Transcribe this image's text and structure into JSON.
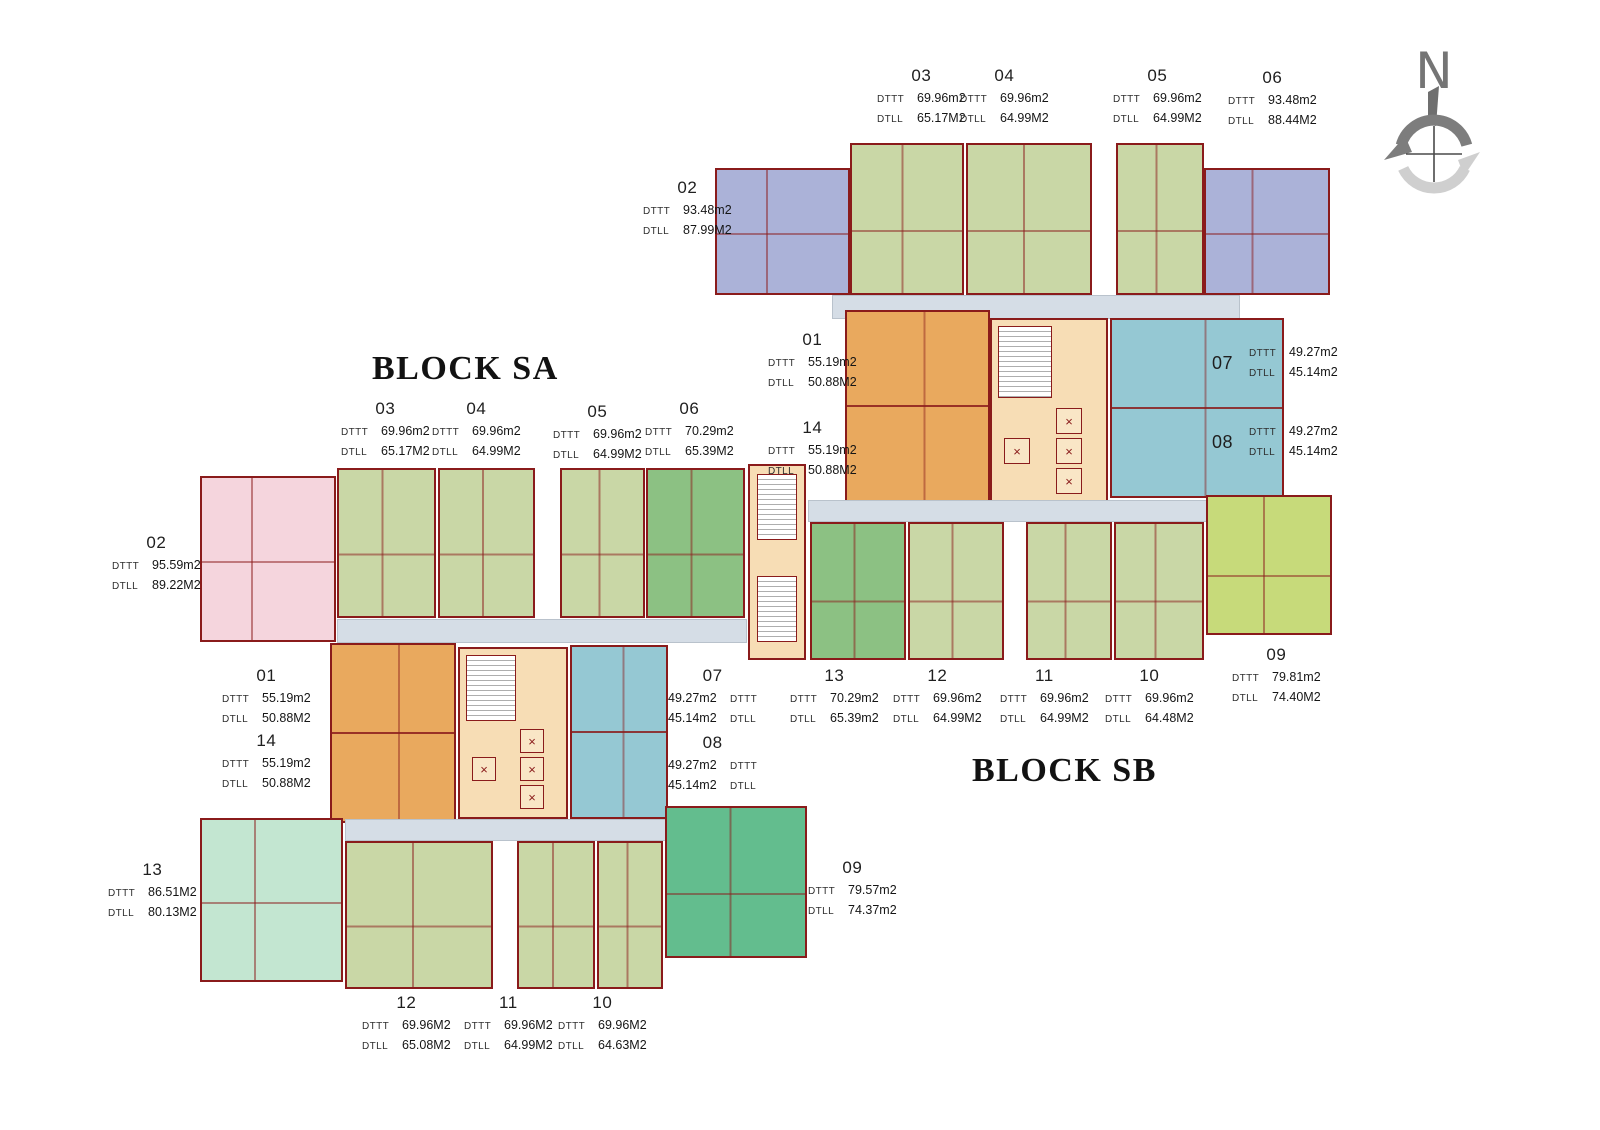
{
  "titles": {
    "block_sa": "BLOCK SA",
    "block_sb": "BLOCK SB"
  },
  "compass": {
    "letter": "N"
  },
  "colors": {
    "wall": "#8a1b1b",
    "unit_green": "#c9d7a6",
    "unit_green_dark": "#8cc183",
    "unit_periwinkle": "#abb2d8",
    "unit_orange": "#e9a95e",
    "unit_teal": "#95c8d3",
    "unit_pink": "#f5d5dd",
    "unit_mint": "#c3e6d1",
    "unit_teal_green": "#63bd8e",
    "unit_lime": "#c7da7a",
    "core_cream": "#f7ddb5",
    "corridor": "#d5dde6"
  },
  "block_sa": {
    "labels": [
      {
        "id": "sa-03",
        "unit": "03",
        "layout": "stack",
        "value_first": false,
        "x": 341,
        "y": 399,
        "rows": [
          [
            "DTTT",
            "69.96m2"
          ],
          [
            "DTLL",
            "65.17M2"
          ]
        ]
      },
      {
        "id": "sa-04",
        "unit": "04",
        "layout": "stack",
        "value_first": false,
        "x": 432,
        "y": 399,
        "rows": [
          [
            "DTTT",
            "69.96m2"
          ],
          [
            "DTLL",
            "64.99M2"
          ]
        ]
      },
      {
        "id": "sa-05",
        "unit": "05",
        "layout": "stack",
        "value_first": false,
        "x": 553,
        "y": 402,
        "rows": [
          [
            "DTTT",
            "69.96m2"
          ],
          [
            "DTLL",
            "64.99M2"
          ]
        ]
      },
      {
        "id": "sa-06",
        "unit": "06",
        "layout": "stack",
        "value_first": false,
        "x": 645,
        "y": 399,
        "rows": [
          [
            "DTTT",
            "70.29m2"
          ],
          [
            "DTLL",
            "65.39M2"
          ]
        ]
      },
      {
        "id": "sa-02",
        "unit": "02",
        "layout": "stack",
        "value_first": false,
        "x": 112,
        "y": 533,
        "rows": [
          [
            "DTTT",
            "95.59m2"
          ],
          [
            "DTLL",
            "89.22M2"
          ]
        ]
      },
      {
        "id": "sa-01",
        "unit": "01",
        "layout": "stack",
        "value_first": false,
        "x": 222,
        "y": 666,
        "rows": [
          [
            "DTTT",
            "55.19m2"
          ],
          [
            "DTLL",
            "50.88M2"
          ]
        ]
      },
      {
        "id": "sa-14",
        "unit": "14",
        "layout": "stack",
        "value_first": false,
        "x": 222,
        "y": 731,
        "rows": [
          [
            "DTTT",
            "55.19m2"
          ],
          [
            "DTLL",
            "50.88M2"
          ]
        ]
      },
      {
        "id": "sa-07",
        "unit": "07",
        "layout": "stack",
        "value_first": true,
        "x": 668,
        "y": 666,
        "rows": [
          [
            "DTTT",
            "49.27m2"
          ],
          [
            "DTLL",
            "45.14m2"
          ]
        ]
      },
      {
        "id": "sa-08",
        "unit": "08",
        "layout": "stack",
        "value_first": true,
        "x": 668,
        "y": 733,
        "rows": [
          [
            "DTTT",
            "49.27m2"
          ],
          [
            "DTLL",
            "45.14m2"
          ]
        ]
      },
      {
        "id": "sa-13",
        "unit": "13",
        "layout": "stack",
        "value_first": false,
        "x": 108,
        "y": 860,
        "rows": [
          [
            "DTTT",
            "86.51M2"
          ],
          [
            "DTLL",
            "80.13M2"
          ]
        ]
      },
      {
        "id": "sa-09",
        "unit": "09",
        "layout": "stack",
        "value_first": false,
        "x": 808,
        "y": 858,
        "rows": [
          [
            "DTTT",
            "79.57m2"
          ],
          [
            "DTLL",
            "74.37m2"
          ]
        ]
      },
      {
        "id": "sa-12",
        "unit": "12",
        "layout": "stack",
        "value_first": false,
        "x": 362,
        "y": 993,
        "rows": [
          [
            "DTTT",
            "69.96M2"
          ],
          [
            "DTLL",
            "65.08M2"
          ]
        ]
      },
      {
        "id": "sa-11",
        "unit": "11",
        "layout": "stack",
        "value_first": false,
        "x": 464,
        "y": 993,
        "rows": [
          [
            "DTTT",
            "69.96M2"
          ],
          [
            "DTLL",
            "64.99M2"
          ]
        ]
      },
      {
        "id": "sa-10",
        "unit": "10",
        "layout": "stack",
        "value_first": false,
        "x": 558,
        "y": 993,
        "rows": [
          [
            "DTTT",
            "69.96M2"
          ],
          [
            "DTLL",
            "64.63M2"
          ]
        ]
      }
    ]
  },
  "block_sb": {
    "labels": [
      {
        "id": "sb-03",
        "unit": "03",
        "layout": "stack",
        "value_first": false,
        "x": 877,
        "y": 66,
        "rows": [
          [
            "DTTT",
            "69.96m2"
          ],
          [
            "DTLL",
            "65.17M2"
          ]
        ]
      },
      {
        "id": "sb-04",
        "unit": "04",
        "layout": "stack",
        "value_first": false,
        "x": 960,
        "y": 66,
        "rows": [
          [
            "DTTT",
            "69.96m2"
          ],
          [
            "DTLL",
            "64.99M2"
          ]
        ]
      },
      {
        "id": "sb-05",
        "unit": "05",
        "layout": "stack",
        "value_first": false,
        "x": 1113,
        "y": 66,
        "rows": [
          [
            "DTTT",
            "69.96m2"
          ],
          [
            "DTLL",
            "64.99M2"
          ]
        ]
      },
      {
        "id": "sb-06",
        "unit": "06",
        "layout": "stack",
        "value_first": false,
        "x": 1228,
        "y": 68,
        "rows": [
          [
            "DTTT",
            "93.48m2"
          ],
          [
            "DTLL",
            "88.44M2"
          ]
        ]
      },
      {
        "id": "sb-02",
        "unit": "02",
        "layout": "stack",
        "value_first": false,
        "x": 643,
        "y": 178,
        "rows": [
          [
            "DTTT",
            "93.48m2"
          ],
          [
            "DTLL",
            "87.99M2"
          ]
        ]
      },
      {
        "id": "sb-01",
        "unit": "01",
        "layout": "stack",
        "value_first": false,
        "x": 768,
        "y": 330,
        "rows": [
          [
            "DTTT",
            "55.19m2"
          ],
          [
            "DTLL",
            "50.88M2"
          ]
        ]
      },
      {
        "id": "sb-14",
        "unit": "14",
        "layout": "stack",
        "value_first": false,
        "x": 768,
        "y": 418,
        "rows": [
          [
            "DTTT",
            "55.19m2"
          ],
          [
            "DTLL",
            "50.88M2"
          ]
        ]
      },
      {
        "id": "sb-07",
        "unit": "07",
        "layout": "side",
        "value_first": false,
        "x": 1212,
        "y": 345,
        "rows": [
          [
            "DTTT",
            "49.27m2"
          ],
          [
            "DTLL",
            "45.14m2"
          ]
        ]
      },
      {
        "id": "sb-08",
        "unit": "08",
        "layout": "side",
        "value_first": false,
        "x": 1212,
        "y": 424,
        "rows": [
          [
            "DTTT",
            "49.27m2"
          ],
          [
            "DTLL",
            "45.14m2"
          ]
        ]
      },
      {
        "id": "sb-09",
        "unit": "09",
        "layout": "stack",
        "value_first": false,
        "x": 1232,
        "y": 645,
        "rows": [
          [
            "DTTT",
            "79.81m2"
          ],
          [
            "DTLL",
            "74.40M2"
          ]
        ]
      },
      {
        "id": "sb-13",
        "unit": "13",
        "layout": "stack",
        "value_first": false,
        "x": 790,
        "y": 666,
        "rows": [
          [
            "DTTT",
            "70.29m2"
          ],
          [
            "DTLL",
            "65.39m2"
          ]
        ]
      },
      {
        "id": "sb-12",
        "unit": "12",
        "layout": "stack",
        "value_first": false,
        "x": 893,
        "y": 666,
        "rows": [
          [
            "DTTT",
            "69.96m2"
          ],
          [
            "DTLL",
            "64.99M2"
          ]
        ]
      },
      {
        "id": "sb-11",
        "unit": "11",
        "layout": "stack",
        "value_first": false,
        "x": 1000,
        "y": 666,
        "rows": [
          [
            "DTTT",
            "69.96m2"
          ],
          [
            "DTLL",
            "64.99M2"
          ]
        ]
      },
      {
        "id": "sb-10",
        "unit": "10",
        "layout": "stack",
        "value_first": false,
        "x": 1105,
        "y": 666,
        "rows": [
          [
            "DTTT",
            "69.96m2"
          ],
          [
            "DTLL",
            "64.48M2"
          ]
        ]
      }
    ]
  }
}
